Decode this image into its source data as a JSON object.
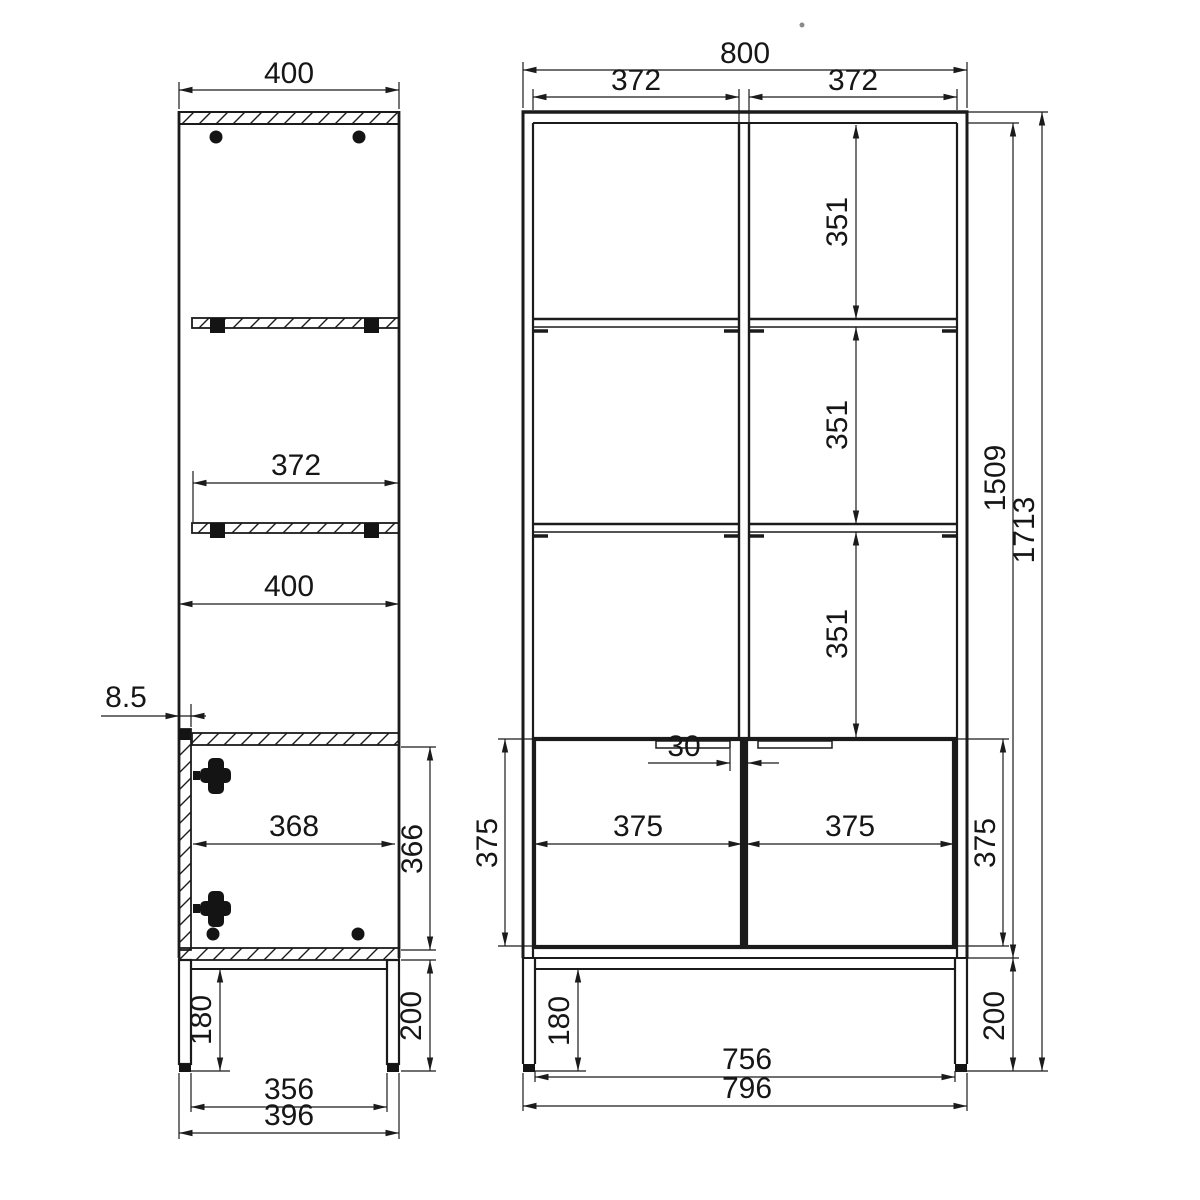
{
  "meta": {
    "drawing_type": "furniture technical drawing, two orthographic views",
    "background_color": "#ffffff",
    "line_color": "#1b1b1b"
  },
  "side_view": {
    "name": "cabinet side section view",
    "dims": {
      "depth": "400",
      "shelf_depth": "372",
      "interior_depth_mid": "400",
      "door_thickness": "8.5",
      "door_interior_depth": "368",
      "door_opening_height": "366",
      "underframe_clearance": "180",
      "leg_height": "200",
      "leg_span_inner": "356",
      "leg_span_outer": "396"
    }
  },
  "front_view": {
    "name": "cabinet front view",
    "dims": {
      "total_width": "800",
      "left_bay_width": "372",
      "right_bay_width": "372",
      "bay_height_top": "351",
      "bay_height_middle": "351",
      "bay_height_bottom": "351",
      "carcass_height": "1509",
      "total_height": "1713",
      "handle_gap": "30",
      "left_door_width": "375",
      "right_door_width": "375",
      "left_door_height": "375",
      "right_door_height": "375",
      "underframe_clearance": "180",
      "leg_height": "200",
      "leg_span_inner": "756",
      "base_width": "796"
    }
  }
}
